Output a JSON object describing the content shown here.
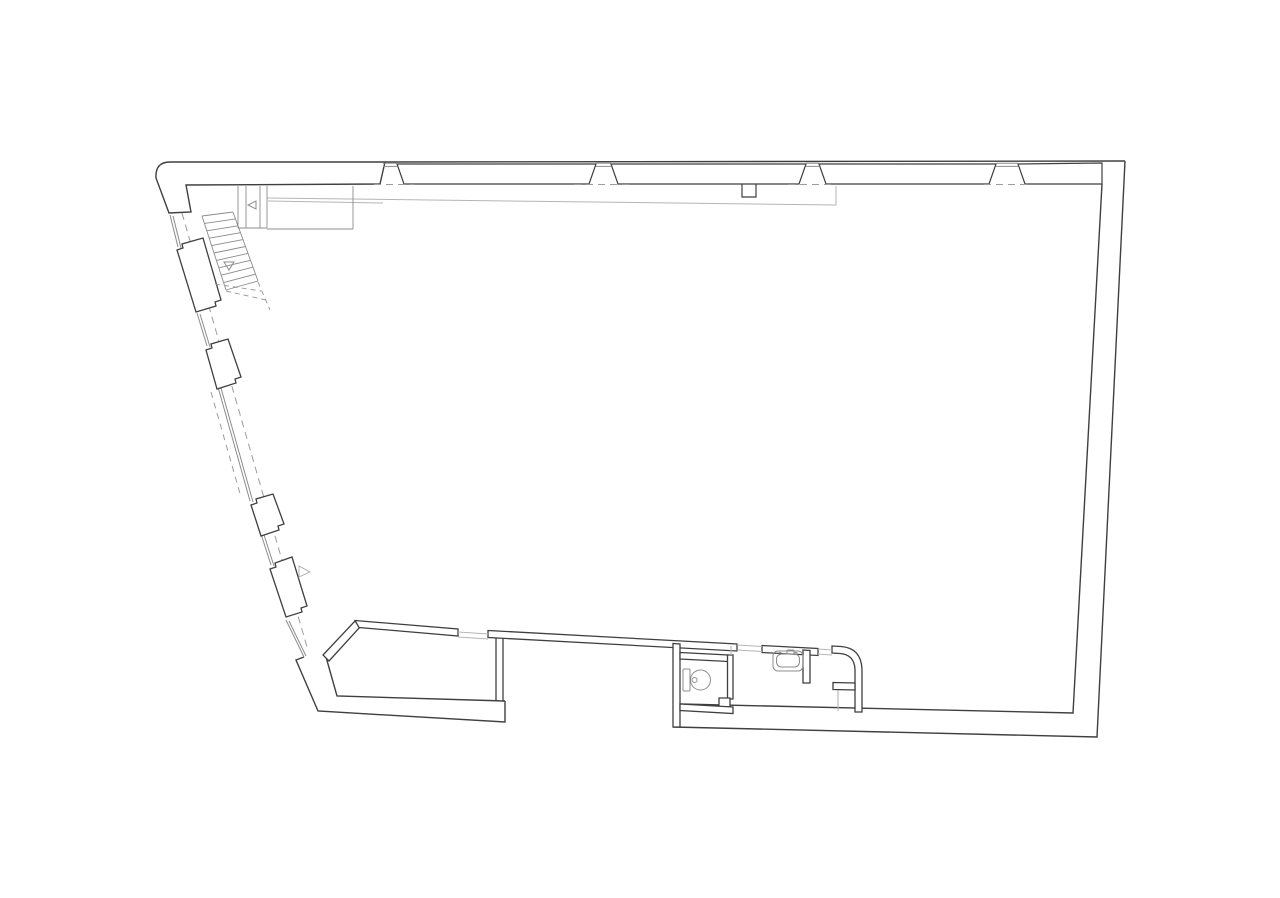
{
  "drawing": {
    "name": "floor-plan",
    "kind": "architectural-plan-line-drawing",
    "visible_text": "none"
  },
  "canvas": {
    "w": 1280,
    "h": 898,
    "bg": "#ffffff"
  },
  "colors": {
    "dark": "#3f3f3f",
    "mid": "#8c8c8c",
    "light": "#b5b5b5",
    "dash": "#9c9c9c",
    "white": "#ffffff"
  },
  "stairs": {
    "band": {
      "a": [
        202,
        216
      ],
      "b": [
        233,
        212
      ],
      "c": [
        258,
        281
      ],
      "d": [
        226,
        290
      ]
    },
    "tread_count": 11
  },
  "shapes": [
    {
      "type": "path",
      "name": "top-left-corner-wall",
      "d": "M169,213 L156,178 Q155,162 170,162 L385,162 L380,184 L186,185 L191,212 Z",
      "s": "dark",
      "w": 1.4,
      "f": "white"
    },
    {
      "type": "path",
      "name": "top-wall-outer-line",
      "d": "M385,162 L1125,161",
      "s": "dark",
      "w": 1.4,
      "f": "none"
    },
    {
      "type": "path",
      "name": "window-bay-1",
      "d": "M397,164 L596,164 L589,184 L404,184 Z",
      "s": "dark",
      "w": 1.2,
      "f": "white"
    },
    {
      "type": "path",
      "name": "window-bay-2",
      "d": "M611,164 L806,164 L799,184 L618,184 Z",
      "s": "dark",
      "w": 1.2,
      "f": "white"
    },
    {
      "type": "path",
      "name": "window-bay-3",
      "d": "M819,164 L996,164 L989,184 L826,184 Z",
      "s": "dark",
      "w": 1.2,
      "f": "white"
    },
    {
      "type": "path",
      "name": "window-bay-4",
      "d": "M1018,164 L1102,163 L1102,184 L1025,184 Z",
      "s": "dark",
      "w": 1.2,
      "f": "white"
    },
    {
      "type": "line",
      "name": "mullion-glazing-1a",
      "x1": 383,
      "y1": 163.2,
      "x2": 397,
      "y2": 163.2,
      "s": "mid",
      "w": 1
    },
    {
      "type": "line",
      "name": "mullion-glazing-1b",
      "x1": 383,
      "y1": 166.4,
      "x2": 397,
      "y2": 166.4,
      "s": "mid",
      "w": 1
    },
    {
      "type": "line",
      "name": "mullion-glazing-2a",
      "x1": 596,
      "y1": 163.2,
      "x2": 611,
      "y2": 163.2,
      "s": "mid",
      "w": 1
    },
    {
      "type": "line",
      "name": "mullion-glazing-2b",
      "x1": 596,
      "y1": 166.4,
      "x2": 611,
      "y2": 166.4,
      "s": "mid",
      "w": 1
    },
    {
      "type": "line",
      "name": "mullion-glazing-3a",
      "x1": 806,
      "y1": 163.2,
      "x2": 819,
      "y2": 163.2,
      "s": "mid",
      "w": 1
    },
    {
      "type": "line",
      "name": "mullion-glazing-3b",
      "x1": 806,
      "y1": 166.4,
      "x2": 819,
      "y2": 166.4,
      "s": "mid",
      "w": 1
    },
    {
      "type": "line",
      "name": "mullion-glazing-4a",
      "x1": 996,
      "y1": 163.2,
      "x2": 1018,
      "y2": 163.2,
      "s": "mid",
      "w": 1
    },
    {
      "type": "line",
      "name": "mullion-glazing-4b",
      "x1": 996,
      "y1": 166.4,
      "x2": 1018,
      "y2": 166.4,
      "s": "mid",
      "w": 1
    },
    {
      "type": "line",
      "name": "top-wall-dash-1",
      "x1": 374,
      "y1": 184.5,
      "x2": 414,
      "y2": 184.5,
      "s": "dash",
      "w": 1,
      "da": "7 5"
    },
    {
      "type": "line",
      "name": "top-wall-dash-2",
      "x1": 574,
      "y1": 184.5,
      "x2": 630,
      "y2": 184.5,
      "s": "dash",
      "w": 1,
      "da": "7 5"
    },
    {
      "type": "line",
      "name": "top-wall-dash-3",
      "x1": 788,
      "y1": 184.5,
      "x2": 836,
      "y2": 184.5,
      "s": "dash",
      "w": 1,
      "da": "7 5"
    },
    {
      "type": "line",
      "name": "top-wall-dash-4",
      "x1": 984,
      "y1": 184.5,
      "x2": 1030,
      "y2": 184.5,
      "s": "dash",
      "w": 1,
      "da": "7 5"
    },
    {
      "type": "path",
      "name": "sill-notch",
      "d": "M742,184 L742,197 L756,197 L756,184",
      "s": "dark",
      "w": 1.2,
      "f": "none"
    },
    {
      "type": "path",
      "name": "right-wall-outer",
      "d": "M1125,161 L1097,737 L673,727",
      "s": "dark",
      "w": 1.4,
      "f": "none"
    },
    {
      "type": "path",
      "name": "right-wall-inner",
      "d": "M1102,184 L1073,713 L680,704",
      "s": "dark",
      "w": 1.4,
      "f": "none"
    },
    {
      "type": "path",
      "name": "bottom-left-wall-outer",
      "d": "M304,657 L296,660 L318,711 L505,722 L505,701",
      "s": "dark",
      "w": 1.4,
      "f": "none"
    },
    {
      "type": "path",
      "name": "bottom-left-wall-inner",
      "d": "M505,701 L337,696 L326,657",
      "s": "dark",
      "w": 1.4,
      "f": "none"
    },
    {
      "type": "line",
      "name": "left-glazing-0a",
      "x1": 170,
      "y1": 215,
      "x2": 178,
      "y2": 247,
      "s": "mid",
      "w": 1
    },
    {
      "type": "line",
      "name": "left-glazing-0b",
      "x1": 173,
      "y1": 216,
      "x2": 181,
      "y2": 248,
      "s": "mid",
      "w": 1
    },
    {
      "type": "line",
      "name": "left-glazing-1a",
      "x1": 197,
      "y1": 313,
      "x2": 207,
      "y2": 346,
      "s": "mid",
      "w": 1
    },
    {
      "type": "line",
      "name": "left-glazing-1b",
      "x1": 200,
      "y1": 314,
      "x2": 210,
      "y2": 347,
      "s": "mid",
      "w": 1
    },
    {
      "type": "line",
      "name": "left-glazing-2a",
      "x1": 218,
      "y1": 387,
      "x2": 250,
      "y2": 501,
      "s": "mid",
      "w": 1
    },
    {
      "type": "line",
      "name": "left-glazing-2b",
      "x1": 221,
      "y1": 388,
      "x2": 253,
      "y2": 502,
      "s": "mid",
      "w": 1
    },
    {
      "type": "line",
      "name": "left-glazing-3a",
      "x1": 261,
      "y1": 534,
      "x2": 271,
      "y2": 565,
      "s": "mid",
      "w": 1
    },
    {
      "type": "line",
      "name": "left-glazing-3b",
      "x1": 264,
      "y1": 535,
      "x2": 274,
      "y2": 566,
      "s": "mid",
      "w": 1
    },
    {
      "type": "line",
      "name": "left-glazing-4a",
      "x1": 286,
      "y1": 620,
      "x2": 304,
      "y2": 657,
      "s": "mid",
      "w": 1
    },
    {
      "type": "line",
      "name": "left-glazing-4b",
      "x1": 289,
      "y1": 621,
      "x2": 306,
      "y2": 656,
      "s": "mid",
      "w": 1
    },
    {
      "type": "line",
      "name": "left-wall-dashed-inner",
      "x1": 182,
      "y1": 213,
      "x2": 307,
      "y2": 647,
      "s": "dash",
      "w": 1,
      "da": "7 5"
    },
    {
      "type": "line",
      "name": "left-wall-dashed-outer",
      "x1": 211,
      "y1": 392,
      "x2": 241,
      "y2": 497,
      "s": "dash",
      "w": 1,
      "da": "6 5"
    },
    {
      "type": "path",
      "name": "window-pier-1",
      "d": "M177,250 L183,248 L182,244 L203,238 L221,300 L215,302 L216,306 L196,312 Z",
      "s": "dark",
      "w": 1.3,
      "f": "white"
    },
    {
      "type": "path",
      "name": "window-pier-2",
      "d": "M206,350 L212,348 L211,344 L228,339 L241,377 L235,379 L236,383 L217,389 Z",
      "s": "dark",
      "w": 1.3,
      "f": "white"
    },
    {
      "type": "path",
      "name": "window-pier-3",
      "d": "M251,505 L257,503 L256,499 L273,494 L284,524 L278,526 L279,530 L261,536 Z",
      "s": "dark",
      "w": 1.3,
      "f": "white"
    },
    {
      "type": "path",
      "name": "window-pier-4",
      "d": "M270,569 L276,567 L275,563 L292,557 L307,606 L301,608 L302,612 L286,617 Z",
      "s": "dark",
      "w": 1.3,
      "f": "white"
    },
    {
      "type": "path",
      "name": "door-swing-left-wall",
      "d": "M299,566 L299,577 L310,572 Z",
      "s": "light",
      "w": 1,
      "f": "none"
    },
    {
      "type": "path",
      "name": "partition-room-diagonal",
      "d": "M323,655 L355,621 L360,627 L329,661 Z",
      "s": "dark",
      "w": 1.3,
      "f": "white"
    },
    {
      "type": "path",
      "name": "partition-room-top",
      "d": "M355,620.5 L458,629 L458,636 L359,627.5 Z",
      "s": "dark",
      "w": 1.3,
      "f": "white"
    },
    {
      "type": "path",
      "name": "partition-room-right",
      "d": "M496,634 L503,634.5 L503,701 L496,700.5 Z",
      "s": "dark",
      "w": 1.3,
      "f": "white"
    },
    {
      "type": "path",
      "name": "partition-long-wall",
      "d": "M488,630.5 L737,644 L737,651 L488,637.5 Z",
      "s": "dark",
      "w": 1.3,
      "f": "white"
    },
    {
      "type": "path",
      "name": "partition-long-wall-2",
      "d": "M762,645.5 L818,648.5 L818,655.5 L762,652.5 Z",
      "s": "dark",
      "w": 1.3,
      "f": "white"
    },
    {
      "type": "path",
      "name": "partition-curved-corner",
      "d": "M832,646 L841,646.5 Q861,648 862,669 L862,712 L855,712 L855,669 Q854,654.5 840,653.5 L832,653 Z",
      "s": "dark",
      "w": 1.3,
      "f": "white"
    },
    {
      "type": "path",
      "name": "partition-niche-stub",
      "d": "M833,682.5 L855,683 L855,690 L833,689.5 Z",
      "s": "dark",
      "w": 1.3,
      "f": "white"
    },
    {
      "type": "path",
      "name": "partition-sink-stub",
      "d": "M803,650 L810,650.5 L810,683 L803,683 Z",
      "s": "dark",
      "w": 1.3,
      "f": "white"
    },
    {
      "type": "path",
      "name": "partition-wc-left",
      "d": "M673,643.5 L680,644 L680,727 L673,727 Z",
      "s": "dark",
      "w": 1.3,
      "f": "white"
    },
    {
      "type": "path",
      "name": "partition-wc-top",
      "d": "M680,652.5 L728,655 L728,661.5 L680,659 Z",
      "s": "dark",
      "w": 1.3,
      "f": "white"
    },
    {
      "type": "path",
      "name": "partition-wc-right",
      "d": "M727.5,655 L733,655 L733,699 L727.5,699 Z",
      "s": "dark",
      "w": 1.3,
      "f": "white"
    },
    {
      "type": "path",
      "name": "partition-wc-notch",
      "d": "M719,698 L730,698 L730,707 L719,707 Z",
      "s": "dark",
      "w": 1.3,
      "f": "white"
    },
    {
      "type": "path",
      "name": "partition-wc-bottom",
      "d": "M680,704 L733,707 L733,713.5 L680,710.5 Z",
      "s": "dark",
      "w": 1.3,
      "f": "white"
    },
    {
      "type": "line",
      "name": "threshold-room-door-a",
      "x1": 458,
      "y1": 632,
      "x2": 488,
      "y2": 634,
      "s": "light",
      "w": 1.1
    },
    {
      "type": "line",
      "name": "threshold-room-door-b",
      "x1": 458,
      "y1": 637,
      "x2": 488,
      "y2": 639,
      "s": "light",
      "w": 1.1
    },
    {
      "type": "line",
      "name": "threshold-bath-door-a",
      "x1": 737,
      "y1": 645,
      "x2": 762,
      "y2": 646.5,
      "s": "light",
      "w": 1.1
    },
    {
      "type": "line",
      "name": "threshold-bath-door-b",
      "x1": 737,
      "y1": 650,
      "x2": 762,
      "y2": 651.5,
      "s": "light",
      "w": 1.1
    },
    {
      "type": "line",
      "name": "threshold-door2-a",
      "x1": 818,
      "y1": 649,
      "x2": 832,
      "y2": 650,
      "s": "light",
      "w": 1.1
    },
    {
      "type": "line",
      "name": "threshold-door2-b",
      "x1": 818,
      "y1": 654,
      "x2": 832,
      "y2": 655,
      "s": "light",
      "w": 1.1
    },
    {
      "type": "line",
      "name": "threshold-wc-door",
      "x1": 731,
      "y1": 646,
      "x2": 731,
      "y2": 655,
      "s": "light",
      "w": 1.1
    },
    {
      "type": "line",
      "name": "threshold-niche-door",
      "x1": 838,
      "y1": 690,
      "x2": 838,
      "y2": 711,
      "s": "light",
      "w": 1.1
    },
    {
      "type": "path",
      "name": "interior-faint-line",
      "d": "M267,198 L836,205 L836,186",
      "s": "light",
      "w": 1,
      "f": "none"
    },
    {
      "type": "line",
      "name": "interior-faint-line-2",
      "x1": 268,
      "y1": 201,
      "x2": 383,
      "y2": 203,
      "s": "light",
      "w": 1
    },
    {
      "type": "line",
      "name": "stair-shaft-v1",
      "x1": 238,
      "y1": 186,
      "x2": 238,
      "y2": 228,
      "s": "mid",
      "w": 0.9
    },
    {
      "type": "line",
      "name": "stair-shaft-v2",
      "x1": 246,
      "y1": 186,
      "x2": 246,
      "y2": 228,
      "s": "mid",
      "w": 0.9
    },
    {
      "type": "line",
      "name": "stair-shaft-v3",
      "x1": 260,
      "y1": 186,
      "x2": 260,
      "y2": 228,
      "s": "mid",
      "w": 0.9
    },
    {
      "type": "line",
      "name": "stair-shaft-v4",
      "x1": 267,
      "y1": 186,
      "x2": 267,
      "y2": 228,
      "s": "mid",
      "w": 0.9
    },
    {
      "type": "line",
      "name": "stair-shaft-h1",
      "x1": 238,
      "y1": 228,
      "x2": 267,
      "y2": 228,
      "s": "mid",
      "w": 0.9
    },
    {
      "type": "line",
      "name": "stair-landing-h",
      "x1": 267,
      "y1": 229,
      "x2": 353,
      "y2": 229,
      "s": "mid",
      "w": 0.9
    },
    {
      "type": "line",
      "name": "stair-landing-v",
      "x1": 353,
      "y1": 186,
      "x2": 353,
      "y2": 229,
      "s": "mid",
      "w": 0.9
    },
    {
      "type": "path",
      "name": "stair-door-swing",
      "d": "M256,201 L256,209 L248,205 Z",
      "s": "mid",
      "w": 1,
      "f": "none"
    },
    {
      "type": "line",
      "name": "stair-rail-left",
      "x1": 202,
      "y1": 216,
      "x2": 226,
      "y2": 290,
      "s": "mid",
      "w": 0.9
    },
    {
      "type": "line",
      "name": "stair-rail-right",
      "x1": 233,
      "y1": 212,
      "x2": 258,
      "y2": 281,
      "s": "mid",
      "w": 0.9
    },
    {
      "type": "path",
      "name": "stair-direction-arrow",
      "d": "M224,262 L234,262 L229,270 Z",
      "s": "mid",
      "w": 1,
      "f": "none"
    },
    {
      "type": "line",
      "name": "stair-break-dash-1",
      "x1": 215,
      "y1": 284,
      "x2": 261,
      "y2": 291,
      "s": "dash",
      "w": 1,
      "da": "5 4"
    },
    {
      "type": "line",
      "name": "stair-break-dash-2",
      "x1": 226,
      "y1": 291,
      "x2": 266,
      "y2": 300,
      "s": "dash",
      "w": 1,
      "da": "5 4"
    },
    {
      "type": "line",
      "name": "stair-break-dash-3",
      "x1": 258,
      "y1": 282,
      "x2": 270,
      "y2": 310,
      "s": "dash",
      "w": 1,
      "da": "5 4"
    },
    {
      "type": "rect",
      "name": "toilet-tank",
      "x": 683,
      "y": 669,
      "wd": 7,
      "ht": 22,
      "rx": 1,
      "s": "mid",
      "w": 1,
      "f": "none"
    },
    {
      "type": "ellipse",
      "name": "toilet-bowl",
      "cx": 700.5,
      "cy": 680,
      "rx": 10,
      "ry": 10,
      "s": "mid",
      "w": 1,
      "f": "none"
    },
    {
      "type": "circle",
      "name": "toilet-flush-button",
      "cx": 694.5,
      "cy": 680,
      "r": 2.5,
      "s": "mid",
      "w": 1,
      "f": "none"
    },
    {
      "type": "rect",
      "name": "sink-basin-outer",
      "x": 773,
      "y": 651,
      "wd": 30,
      "ht": 20,
      "rx": 5,
      "s": "mid",
      "w": 1,
      "f": "none"
    },
    {
      "type": "rect",
      "name": "sink-basin-inner",
      "x": 776.5,
      "y": 654,
      "wd": 23,
      "ht": 13,
      "rx": 5,
      "s": "mid",
      "w": 1,
      "f": "none"
    },
    {
      "type": "rect",
      "name": "sink-faucet",
      "x": 787,
      "y": 650,
      "wd": 7,
      "ht": 4,
      "rx": 1,
      "s": "mid",
      "w": 1,
      "f": "none"
    },
    {
      "type": "circle",
      "name": "sink-tap-left",
      "cx": 780,
      "cy": 653.5,
      "r": 1.2,
      "s": "mid",
      "w": 0.8,
      "f": "none"
    },
    {
      "type": "circle",
      "name": "sink-tap-right",
      "cx": 796,
      "cy": 653.5,
      "r": 1.2,
      "s": "mid",
      "w": 0.8,
      "f": "none"
    }
  ]
}
